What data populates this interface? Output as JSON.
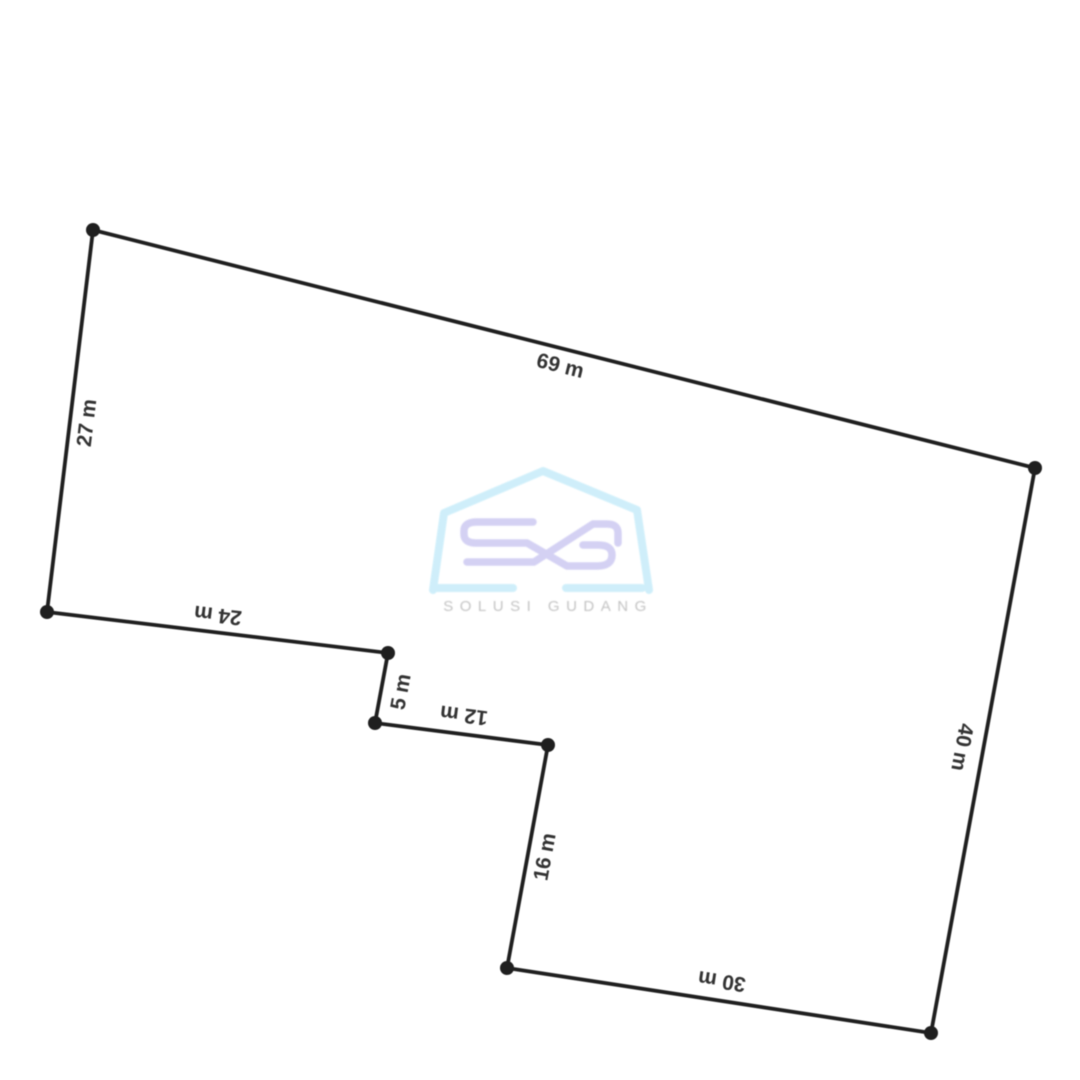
{
  "diagram": {
    "title": "land-plot-outline",
    "unit": "m",
    "line_color": "#1f1f1f",
    "label_color": "#333333",
    "background_color": "#ffffff",
    "vertices": [
      {
        "x": 93,
        "y": 230
      },
      {
        "x": 1035,
        "y": 468
      },
      {
        "x": 931,
        "y": 1033
      },
      {
        "x": 507,
        "y": 968
      },
      {
        "x": 548,
        "y": 745
      },
      {
        "x": 375,
        "y": 723
      },
      {
        "x": 388,
        "y": 653
      },
      {
        "x": 47,
        "y": 612
      }
    ],
    "edges": [
      {
        "label": "69 m",
        "length_m": 69,
        "x": 560,
        "y": 367,
        "rotation": 14.2
      },
      {
        "label": "40 m",
        "length_m": 40,
        "x": 961,
        "y": 747,
        "rotation": 100.4
      },
      {
        "label": "30 m",
        "length_m": 30,
        "x": 722,
        "y": 980,
        "rotation": 188.7
      },
      {
        "label": "16 m",
        "length_m": 16,
        "x": 546,
        "y": 857,
        "rotation": -79.6
      },
      {
        "label": "12 m",
        "length_m": 12,
        "x": 464,
        "y": 714,
        "rotation": 187.3
      },
      {
        "label": "5 m",
        "length_m": 5,
        "x": 402,
        "y": 692,
        "rotation": -79.5
      },
      {
        "label": "24 m",
        "length_m": 24,
        "x": 218,
        "y": 614,
        "rotation": 186.9
      },
      {
        "label": "27 m",
        "length_m": 27,
        "x": 88,
        "y": 423,
        "rotation": -83.1
      }
    ]
  },
  "watermark": {
    "brand_initials": "SG",
    "brand_name": "SOLUSI GUDANG",
    "house_color": "#cdeefa",
    "initials_color": "#d2cff3",
    "text_color": "#bfbfbf"
  }
}
